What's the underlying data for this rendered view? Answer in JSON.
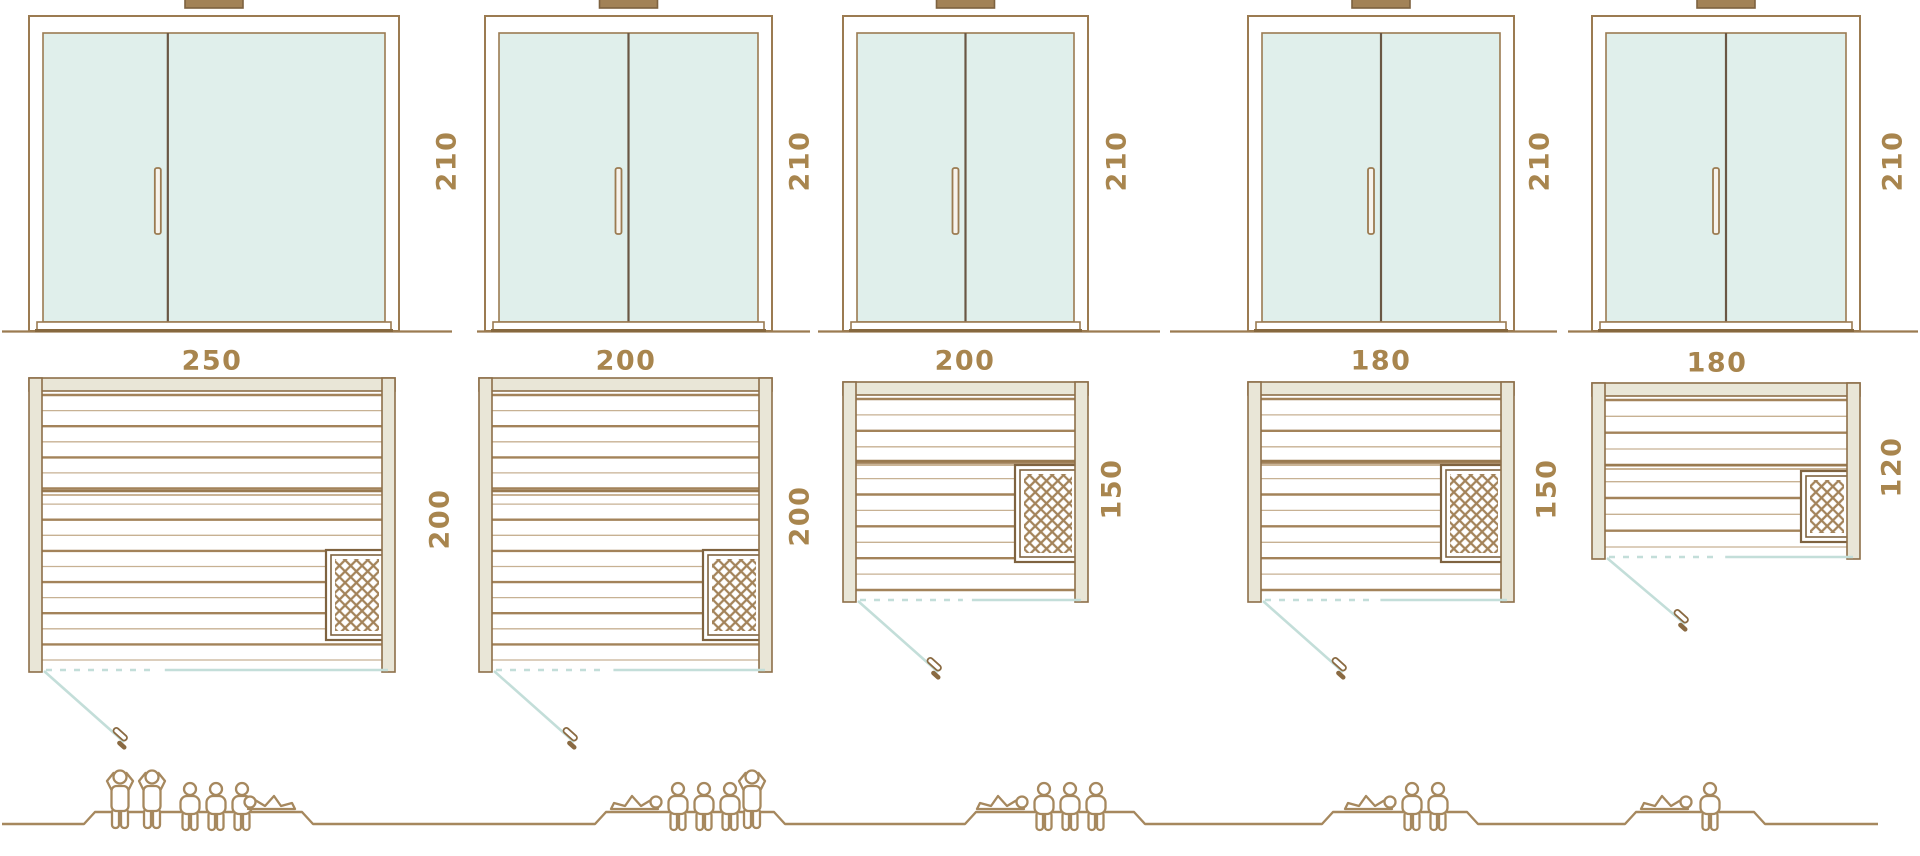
{
  "page": {
    "description": "Sauna size comparison diagram: five glass-front saunas shown as front elevations with door height (cm), floor plans with width and depth dimensions (cm), door swing, heater position, and capacity figures on a baseline",
    "background": "#ffffff"
  },
  "colors": {
    "outline_brown": "#9b7b51",
    "dimension_text": "#a8854e",
    "glass_teal": "#e0efeb",
    "frame_beige": "#e9e6d7",
    "door_swing_teal": "#c3ded9",
    "plank_dark": "#a3835a",
    "plank_light": "#c7b193",
    "figure_outline": "#a6885e",
    "handle_brown": "#8a6a42"
  },
  "saunas": [
    {
      "name": "sauna-250x200",
      "door_height": "210",
      "plan_width": "250",
      "plan_depth": "200",
      "capacity": {
        "standing": 2,
        "sitting": 3,
        "lying": 1,
        "total": 6
      },
      "figures": [
        "standing",
        "standing",
        "sitting",
        "sitting",
        "sitting",
        "lying"
      ]
    },
    {
      "name": "sauna-200x200",
      "door_height": "210",
      "plan_width": "200",
      "plan_depth": "200",
      "capacity": {
        "standing": 1,
        "sitting": 3,
        "lying": 1,
        "total": 5
      },
      "figures": [
        "lying",
        "sitting",
        "sitting",
        "sitting",
        "standing"
      ]
    },
    {
      "name": "sauna-200x150",
      "door_height": "210",
      "plan_width": "200",
      "plan_depth": "150",
      "capacity": {
        "standing": 0,
        "sitting": 3,
        "lying": 1,
        "total": 4
      },
      "figures": [
        "lying",
        "sitting",
        "sitting",
        "sitting"
      ]
    },
    {
      "name": "sauna-180x150",
      "door_height": "210",
      "plan_width": "180",
      "plan_depth": "150",
      "capacity": {
        "standing": 0,
        "sitting": 2,
        "lying": 1,
        "total": 3
      },
      "figures": [
        "lying",
        "sitting",
        "sitting"
      ]
    },
    {
      "name": "sauna-180x120",
      "door_height": "210",
      "plan_width": "180",
      "plan_depth": "120",
      "capacity": {
        "standing": 0,
        "sitting": 1,
        "lying": 1,
        "total": 2
      },
      "figures": [
        "lying",
        "sitting"
      ]
    }
  ]
}
